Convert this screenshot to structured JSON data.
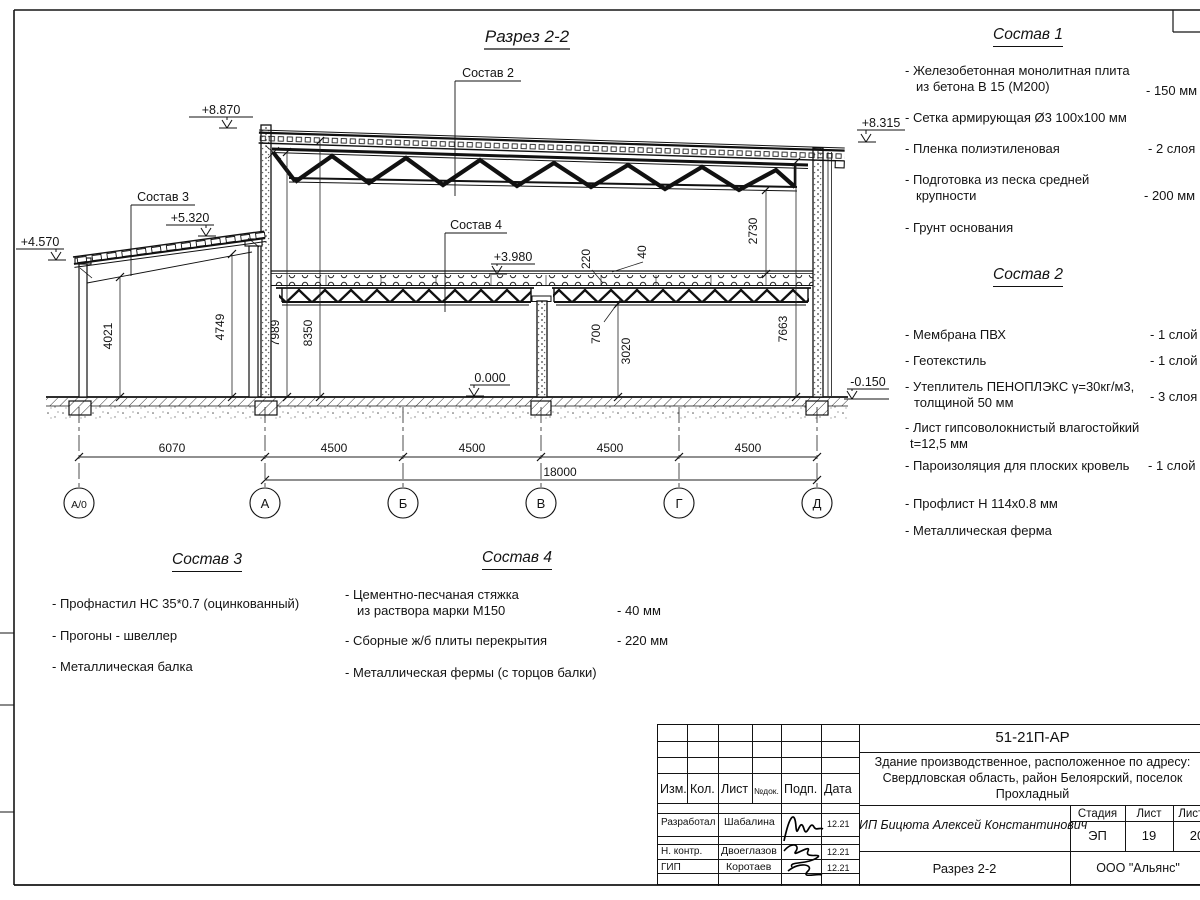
{
  "drawing": {
    "title": "Разрез 2-2",
    "labels": {
      "sostav2": "Состав 2",
      "sostav3": "Состав 3",
      "sostav4": "Состав 4"
    },
    "elevations": {
      "e8870": "+8.870",
      "e8315": "+8.315",
      "e5320": "+5.320",
      "e4570": "+4.570",
      "e3980": "+3.980",
      "e0": "0.000",
      "em150": "-0.150"
    },
    "vdims": {
      "d4021": "4021",
      "d4749": "4749",
      "d7989": "7989",
      "d8350": "8350",
      "d220": "220",
      "d40": "40",
      "d700": "700",
      "d3020": "3020",
      "d2730": "2730",
      "d7663": "7663"
    },
    "hdims": {
      "d6070": "6070",
      "d4500": "4500",
      "d18000": "18000"
    },
    "axes": {
      "a0": "А/0",
      "a": "А",
      "b": "Б",
      "v": "В",
      "g": "Г",
      "d": "Д"
    }
  },
  "sostav1": {
    "title": "Состав 1",
    "items": [
      {
        "l1": "- Железобетонная монолитная плита",
        "l2": "из бетона В 15 (М200)",
        "v": "- 150 мм"
      },
      {
        "l1": "- Сетка армирующая Ø3 100х100 мм",
        "v": ""
      },
      {
        "l1": "- Пленка полиэтиленовая",
        "v": "- 2 слоя"
      },
      {
        "l1": "- Подготовка из песка средней",
        "l2": "крупности",
        "v": "- 200 мм"
      },
      {
        "l1": "- Грунт основания",
        "v": ""
      }
    ]
  },
  "sostav2": {
    "title": "Состав 2",
    "items": [
      {
        "l1": "- Мембрана ПВХ",
        "v": "- 1 слой"
      },
      {
        "l1": "- Геотекстиль",
        "v": "- 1 слой"
      },
      {
        "l1": "- Утеплитель ПЕНОПЛЭКС γ=30кг/м3,",
        "l2": "толщиной 50 мм",
        "v": "- 3 слоя"
      },
      {
        "l1": "- Лист гипсоволокнистый влагостойкий",
        "l2": "t=12,5 мм",
        "v": ""
      },
      {
        "l1": "- Пароизоляция для плоских кровель",
        "v": "- 1 слой"
      },
      {
        "l1": "- Профлист Н 114х0.8 мм",
        "v": ""
      },
      {
        "l1": "- Металлическая ферма",
        "v": ""
      }
    ]
  },
  "sostav3": {
    "title": "Состав 3",
    "items": [
      {
        "l1": "- Профнастил НС 35*0.7 (оцинкованный)"
      },
      {
        "l1": "- Прогоны - швеллер"
      },
      {
        "l1": "- Металлическая балка"
      }
    ]
  },
  "sostav4": {
    "title": "Состав 4",
    "items": [
      {
        "l1": "- Цементно-песчаная стяжка",
        "l2": "из раствора марки М150",
        "v": "- 40 мм"
      },
      {
        "l1": "- Сборные ж/б плиты перекрытия",
        "v": "- 220 мм"
      },
      {
        "l1": "- Металлическая фермы (с торцов балки)",
        "v": ""
      }
    ]
  },
  "titleblock": {
    "doc_number": "51-21П-АР",
    "project_line1": "Здание производственное, расположенное по адресу:",
    "project_line2": "Свердловская область, район Белоярский, поселок",
    "project_line3": "Прохладный",
    "header": [
      "Изм.",
      "Кол.",
      "Лист",
      "№док.",
      "Подп.",
      "Дата"
    ],
    "rows": [
      {
        "role": "Разработал",
        "name": "Шабалина",
        "date": "12.21"
      },
      {
        "role": "Н. контр.",
        "name": "Двоеглазов",
        "date": "12.21"
      },
      {
        "role": "ГИП",
        "name": "Коротаев",
        "date": "12.21"
      }
    ],
    "company": "ИП Бицюта Алексей Константинович",
    "stage_label": "Стадия",
    "list_label": "Лист",
    "listov_label": "Листов",
    "stage": "ЭП",
    "list": "19",
    "listov": "20",
    "view": "Разрез 2-2",
    "org": "ООО \"Альянс\""
  }
}
